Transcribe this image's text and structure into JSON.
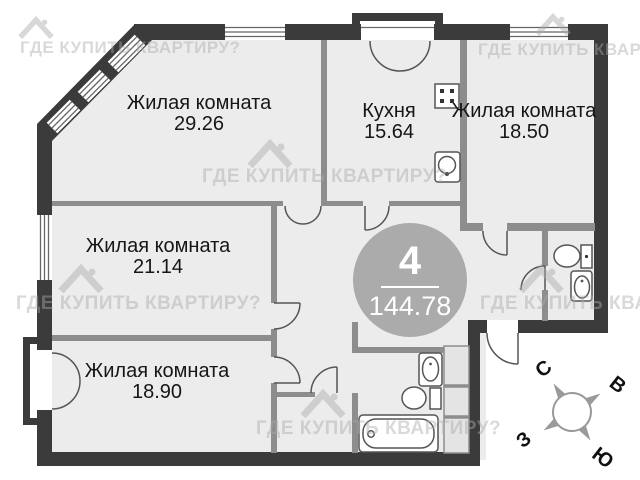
{
  "plan": {
    "rooms": [
      {
        "name": "Жилая комната",
        "area": "29.26"
      },
      {
        "name": "Кухня",
        "area": "15.64"
      },
      {
        "name": "Жилая комната",
        "area": "18.50"
      },
      {
        "name": "Жилая комната",
        "area": "21.14"
      },
      {
        "name": "Жилая комната",
        "area": "18.90"
      }
    ],
    "badge": {
      "room_count": "4",
      "total_area": "144.78"
    },
    "compass": {
      "north": "С",
      "east": "В",
      "west": "З",
      "south": "Ю"
    },
    "watermark_text": "ГДЕ КУПИТЬ КВАРТИРУ?",
    "colors": {
      "exterior_wall": "#3b3b3b",
      "interior_wall": "#8d8d8d",
      "floor": "#ececec",
      "badge": "#ababab",
      "fixture_stroke": "#555555",
      "watermark": "#aaaaaa"
    }
  }
}
